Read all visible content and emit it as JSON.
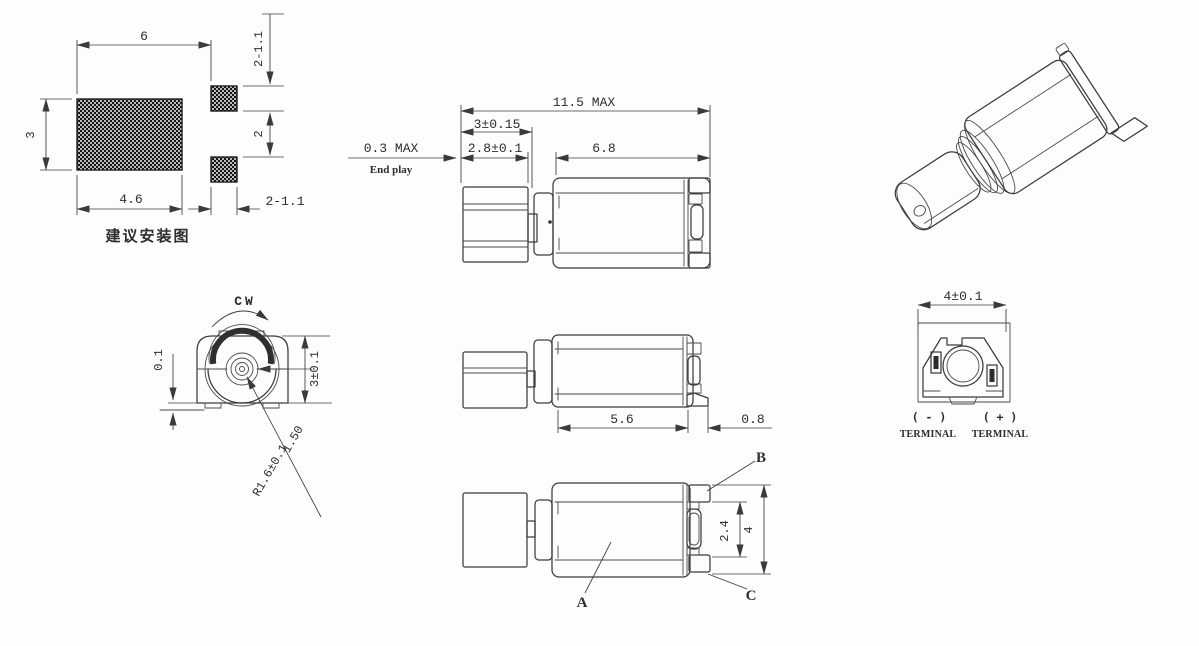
{
  "meta": {
    "background": "#fdfdfd",
    "line_color": "#3c3c3c",
    "pad_fill": "#141414"
  },
  "land_pattern": {
    "title": "建议安装图",
    "dims": {
      "width_top": "6",
      "height": "3",
      "width_bottom": "4.6",
      "pads_top": "2-1.1",
      "pad_gap": "2",
      "pads_bottom": "2-1.1"
    }
  },
  "side_view": {
    "dims": {
      "overall": "11.5 MAX",
      "weight_len": "3±0.15",
      "weight_body": "2.8±0.1",
      "end_play": "0.3 MAX",
      "end_play_label": "End play",
      "body_len": "6.8"
    }
  },
  "front_view": {
    "rotation": "CW",
    "dims": {
      "clearance": "0.1",
      "height": "3±0.1",
      "center_height": "1.50",
      "radius": "R1.6±0.1"
    }
  },
  "mid_view": {
    "dims": {
      "can_len": "5.6",
      "bracket": "0.8"
    }
  },
  "top_view": {
    "labels": {
      "a": "A",
      "b": "B",
      "c": "C"
    },
    "dims": {
      "terminal_gap": "2.4",
      "width": "4"
    }
  },
  "end_view": {
    "dims": {
      "width": "4±0.1"
    },
    "negative": {
      "sign": "( - )",
      "label": "TERMINAL"
    },
    "positive": {
      "sign": "( + )",
      "label": "TERMINAL"
    }
  }
}
